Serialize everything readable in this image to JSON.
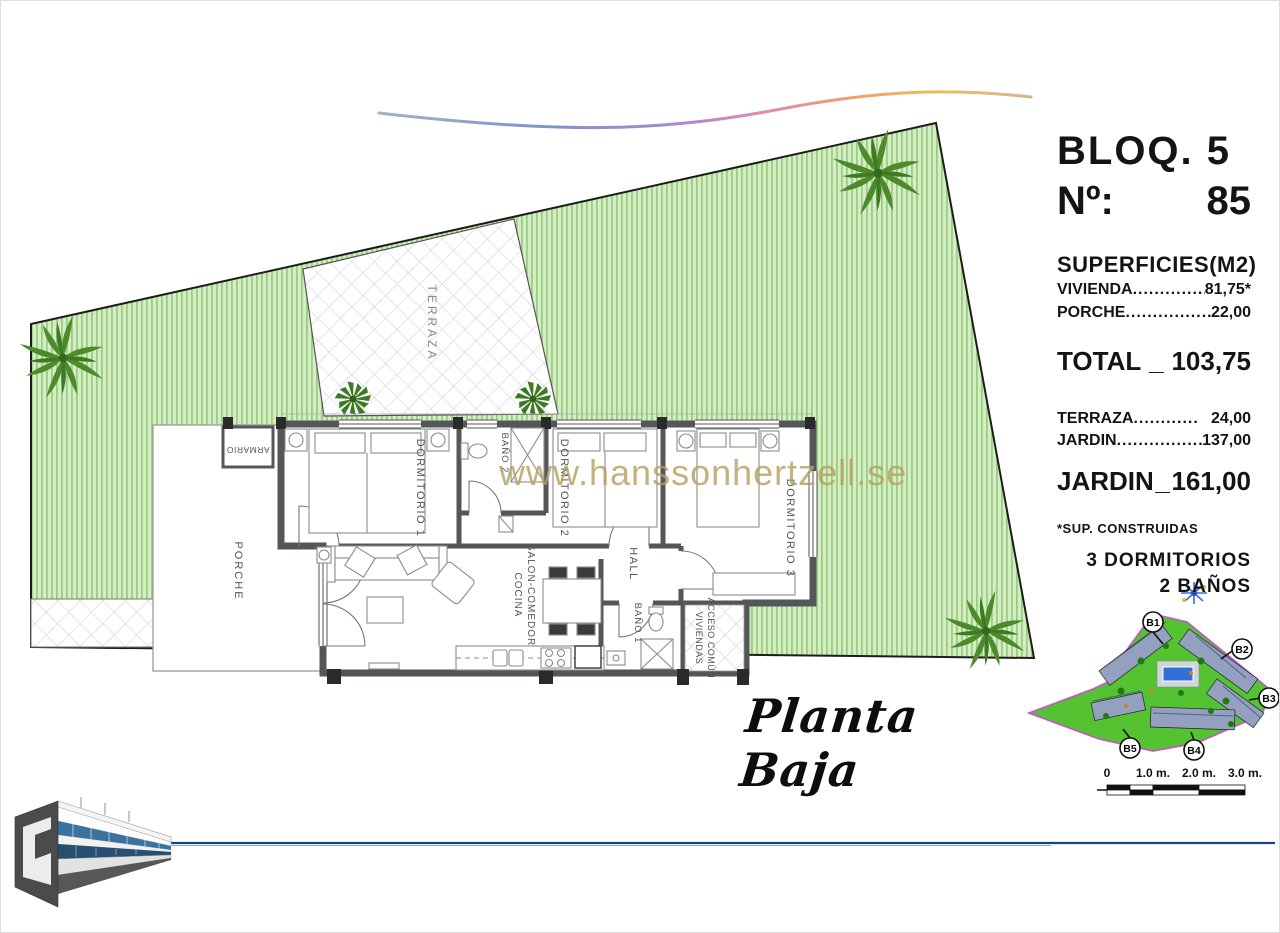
{
  "header": {
    "block": "BLOQ. 5",
    "no_label": "Nº:",
    "no_value": "85"
  },
  "surfaces": {
    "title": "SUPERFICIES(M2)",
    "rows": [
      {
        "label": "VIVIENDA",
        "dots": "..................",
        "value": "81,75*"
      },
      {
        "label": "PORCHE",
        "dots": "...................",
        "value": "22,00"
      }
    ],
    "total": {
      "label": "TOTAL",
      "sep": "_",
      "value": "103,75"
    },
    "outdoor": [
      {
        "label": "TERRAZA",
        "dots": "............",
        "value": "24,00"
      },
      {
        "label": "JARDIN",
        "dots": "...................",
        "value": "137,00"
      }
    ],
    "garden_total": {
      "label": "JARDIN",
      "sep": "_",
      "value": "161,00"
    },
    "footnote": "*SUP. CONSTRUIDAS",
    "bedrooms": "3 DORMITORIOS",
    "bathrooms": "2 BAÑOS"
  },
  "plan": {
    "title": "Planta Baja",
    "watermark": "www.hanssonhertzell.se",
    "rooms": {
      "terraza": "TERRAZA",
      "armario": "ARMARIO",
      "dormitorio1": "DORMITORIO 1",
      "bano2": "BAÑO 2",
      "dormitorio2": "DORMITORIO 2",
      "dormitorio3": "DORMITORIO 3",
      "porche": "PORCHE",
      "salon_line1": "SALON-COMEDOR",
      "salon_line2": "COCINA",
      "hall": "HALL",
      "bano1": "BAÑO 1",
      "acceso_line1": "ACCESO COMÚN",
      "acceso_line2": "VIVIENDAS"
    }
  },
  "scale_bar": {
    "labels": [
      "0",
      "1.0 m.",
      "2.0 m.",
      "3.0 m."
    ]
  },
  "key_map": {
    "blocks": [
      "B1",
      "B2",
      "B3",
      "B4",
      "B5"
    ]
  },
  "colors": {
    "garden_green": "#d5edc2",
    "garden_stripe": "#9ccd84",
    "wall_grey": "#55565a",
    "watermark_gold": "#b5a05f",
    "keymap_green": "#55c232",
    "keymap_outline": "#c94fd0",
    "horizon_blue": "#17458a"
  }
}
